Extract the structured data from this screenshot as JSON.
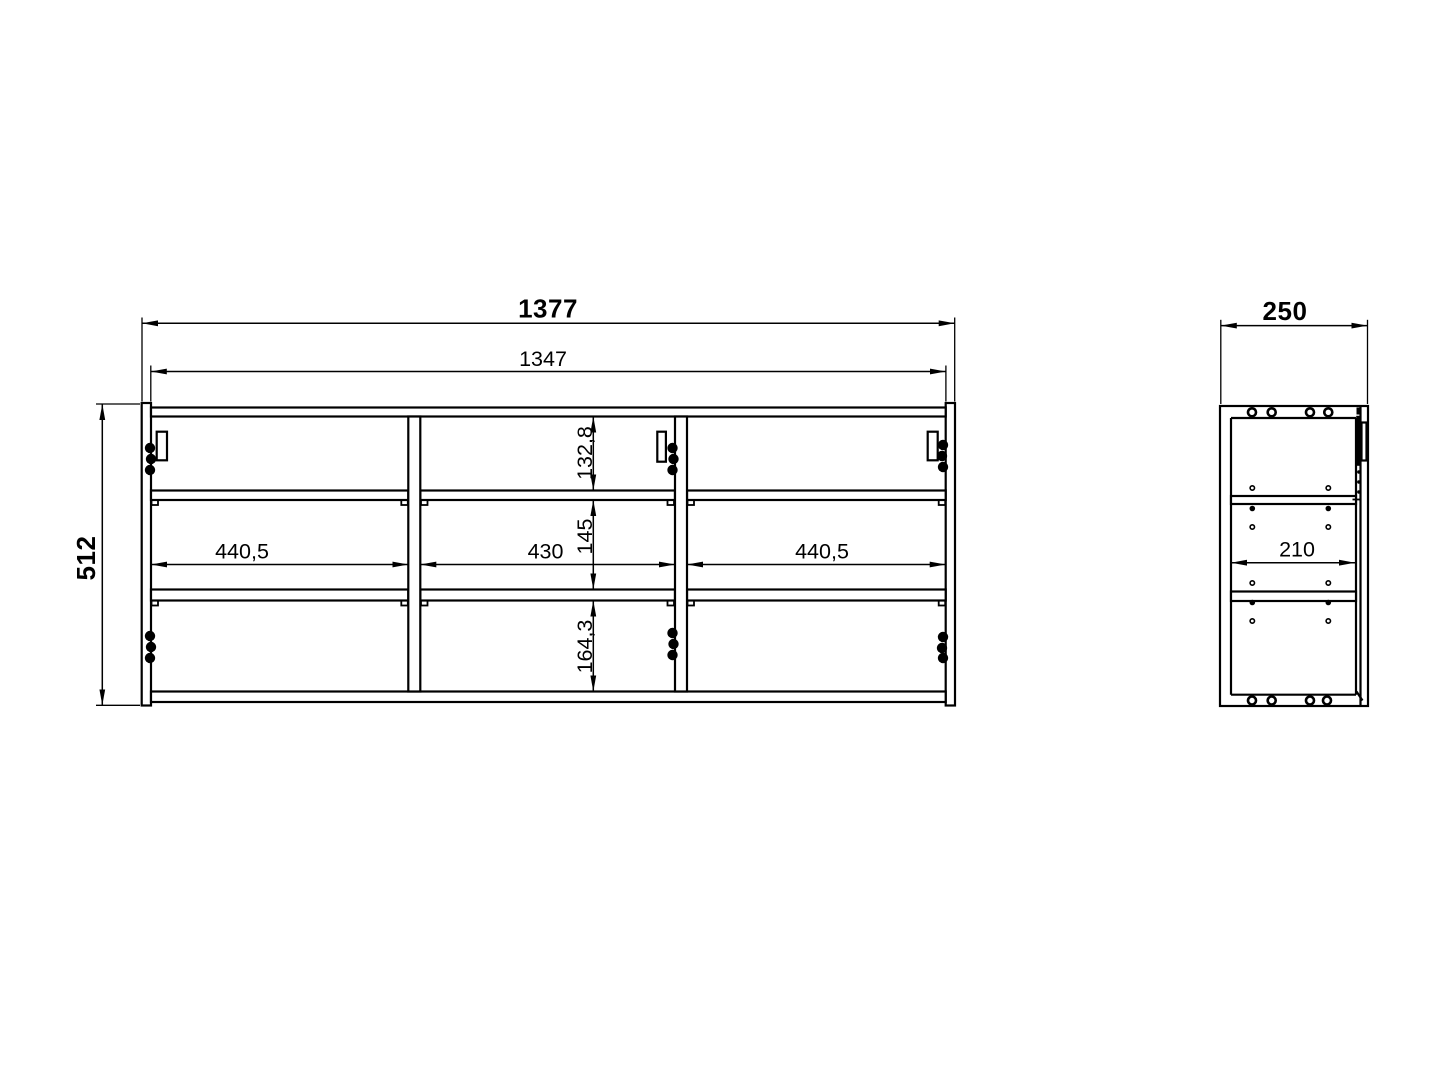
{
  "drawing": {
    "type": "furniture technical drawing, front and side orthographic views",
    "line_color": "#000000",
    "background_color": "#ffffff",
    "front_view": {
      "overall_width": "1377",
      "inner_width": "1347",
      "overall_height": "512",
      "compartment_widths": [
        "440,5",
        "430",
        "440,5"
      ],
      "compartment_heights": [
        "132,8",
        "145",
        "164,3"
      ]
    },
    "side_view": {
      "overall_depth": "250",
      "inner_depth": "210"
    }
  }
}
